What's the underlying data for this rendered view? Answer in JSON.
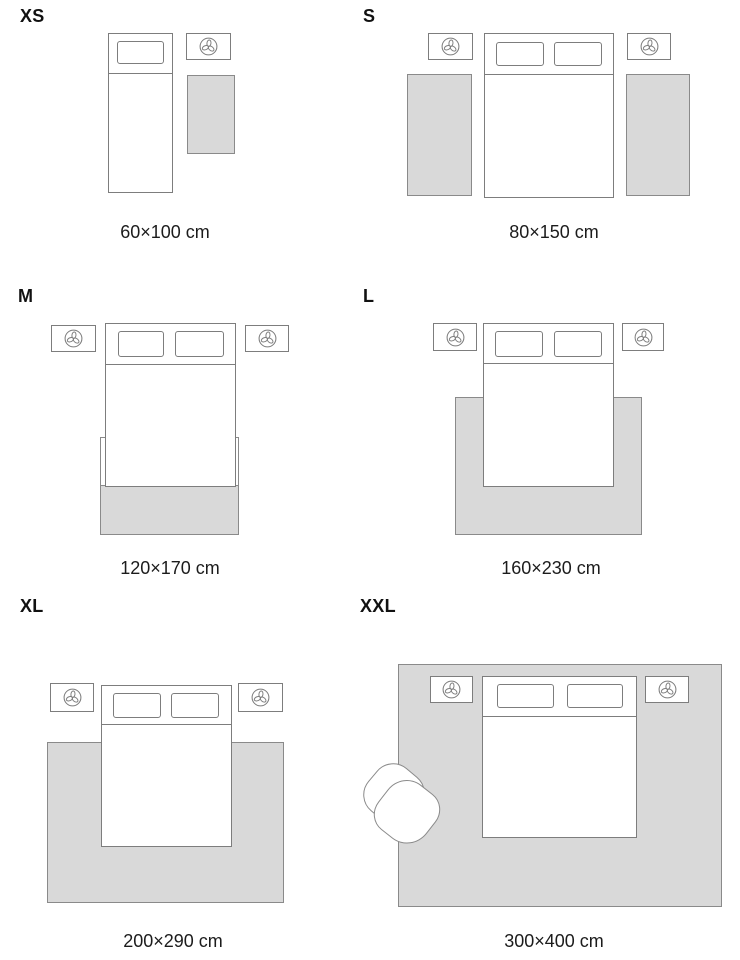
{
  "guide": {
    "sizes": [
      {
        "code": "XS",
        "dimensions": "60×100 cm"
      },
      {
        "code": "S",
        "dimensions": "80×150 cm"
      },
      {
        "code": "M",
        "dimensions": "120×170 cm"
      },
      {
        "code": "L",
        "dimensions": "160×230 cm"
      },
      {
        "code": "XL",
        "dimensions": "200×290 cm"
      },
      {
        "code": "XXL",
        "dimensions": "300×400 cm"
      }
    ]
  },
  "icons": {
    "nightstand_decor": "plant-icon"
  },
  "colors": {
    "background": "#ffffff",
    "rug_fill": "#d9d9d9",
    "rug_border": "#8a8a8a",
    "furniture_outline": "#7d7d7d",
    "text": "#1c1c1c"
  }
}
